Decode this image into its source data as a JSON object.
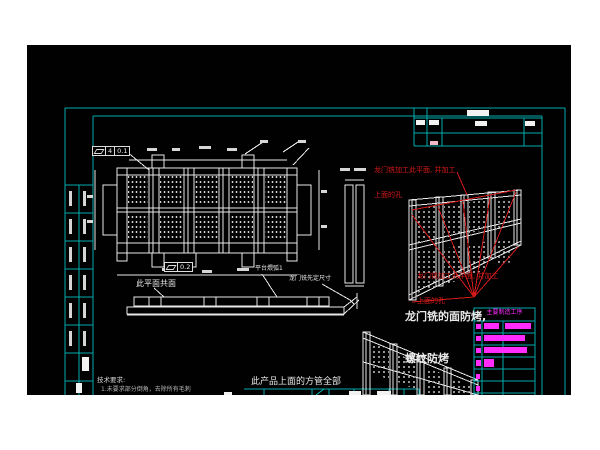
{
  "colors": {
    "frame_cyan": "#00AAAA",
    "line_white": "#E8E8E8",
    "markup_red": "#D61A1A",
    "highlight_magenta": "#FF2BFF",
    "canvas_black": "#010101"
  },
  "notes": {
    "red_top": {
      "line1": "龙门铣加工此平面, 并加工",
      "line2": "上面的孔"
    },
    "red_bottom": {
      "line1": "龙门铣加工此平面, 并加工",
      "line2": "上面的孔"
    },
    "bake": {
      "line1": "龙门铣的面防烤,",
      "line2": "螺纹防烤"
    },
    "tube": {
      "line1": "此产品上面的方管全部",
      "line2": "为150*150*10.0方管"
    },
    "coplanar": "此平面共面",
    "platform_arc": "平台煨弧1",
    "gantry_size": "龙门铣先定尺寸",
    "tech_title": "技术要求:",
    "tech_line1": "1.未要求部分倒角，去除所有毛刺"
  },
  "tolerances": {
    "fcf1_value": "4",
    "fcf1_tol": "0.1",
    "fcf2_tol": "0.2"
  },
  "process_table": {
    "title": "主要制造工序"
  }
}
